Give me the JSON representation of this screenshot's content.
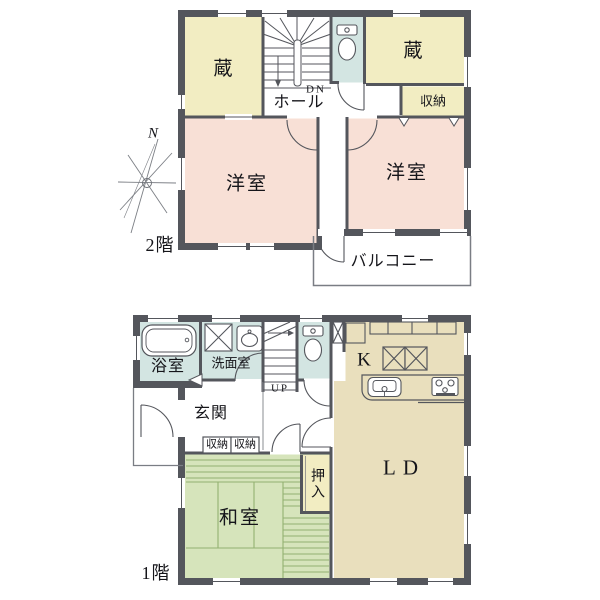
{
  "title": "2階建て住宅 間取り図",
  "compass": {
    "north_label": "N"
  },
  "second_floor": {
    "floor_label": "2階",
    "rooms": {
      "kura_left": "蔵",
      "kura_right": "蔵",
      "hall": "ホール",
      "stairs_direction": "DN",
      "closet": "収納",
      "bedroom_left": "洋室",
      "bedroom_right": "洋室",
      "balcony": "バルコニー"
    }
  },
  "first_floor": {
    "floor_label": "1階",
    "rooms": {
      "bathroom": "浴室",
      "washroom": "洗面室",
      "stairs_direction": "UP",
      "entrance": "玄関",
      "shoe_closet_1": "収納",
      "shoe_closet_2": "収納",
      "tatami_room": "和室",
      "oshiire_closet": "押入",
      "kitchen": "K",
      "living_dining": "LD"
    }
  },
  "colors": {
    "wall": "#54565c",
    "storage_yellow": "#f2edc2",
    "bedroom_pink": "#f8e0d6",
    "wet_area_blue": "#d3e5e2",
    "living_tan": "#e9dfbd",
    "tatami_green": "#d6e4bb",
    "tatami_line": "#93b171"
  }
}
